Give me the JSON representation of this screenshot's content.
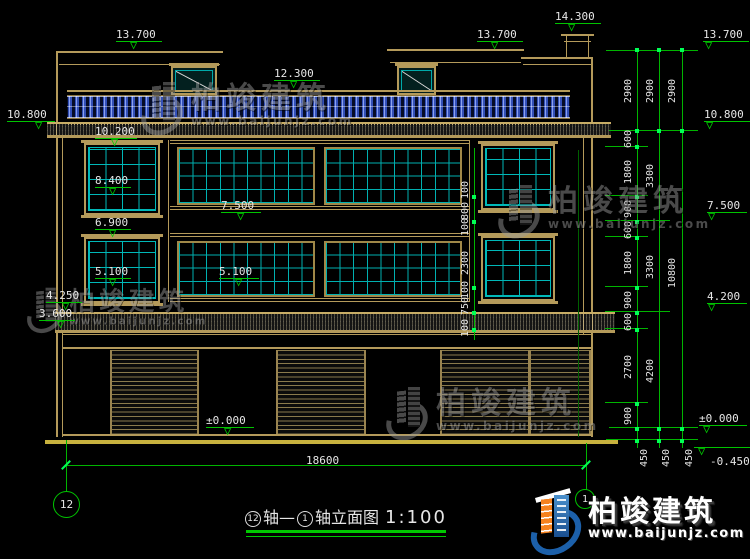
{
  "watermark": {
    "brand": "柏竣建筑",
    "url": "www.baijunjz.com"
  },
  "logo": {
    "brand": "柏竣建筑",
    "url": "www.baijunjz.com"
  },
  "title": {
    "axis_start": "12",
    "axis_join": "轴—",
    "axis_end": "1",
    "suffix": "轴立面图",
    "scale": "1:100"
  },
  "axis_bubbles": {
    "left": "12",
    "right": "1"
  },
  "elevations": {
    "roof_left": "13.700",
    "balustrade": "12.300",
    "roof_right": "13.700",
    "stair_top": "14.300",
    "r_roof": "13.700",
    "l_slab": "10.800",
    "win3_head": "10.200",
    "win3_sill": "8.400",
    "m_7500": "7.500",
    "l_6900": "6.900",
    "l_5100": "5.100",
    "m_5100": "5.100",
    "l_4250": "4.250",
    "l_3600": "3.600",
    "m_zero": "±0.000",
    "r_slab": "10.800",
    "r_7500": "7.500",
    "r_4200": "4.200",
    "r_zero": "±0.000",
    "r_neg": "-0.450"
  },
  "dimensions": {
    "overall_width": "18600",
    "col1": [
      "2900",
      "600",
      "1800",
      "900",
      "600",
      "1800",
      "900",
      "600",
      "2700",
      "900"
    ],
    "col2": [
      "2900",
      "3300",
      "3300",
      "4200"
    ],
    "col3": [
      "2900",
      "10800"
    ],
    "base": [
      "450",
      "450",
      "450"
    ],
    "mid": [
      "100",
      "800",
      "100",
      "2300",
      "100",
      "750",
      "100"
    ]
  }
}
